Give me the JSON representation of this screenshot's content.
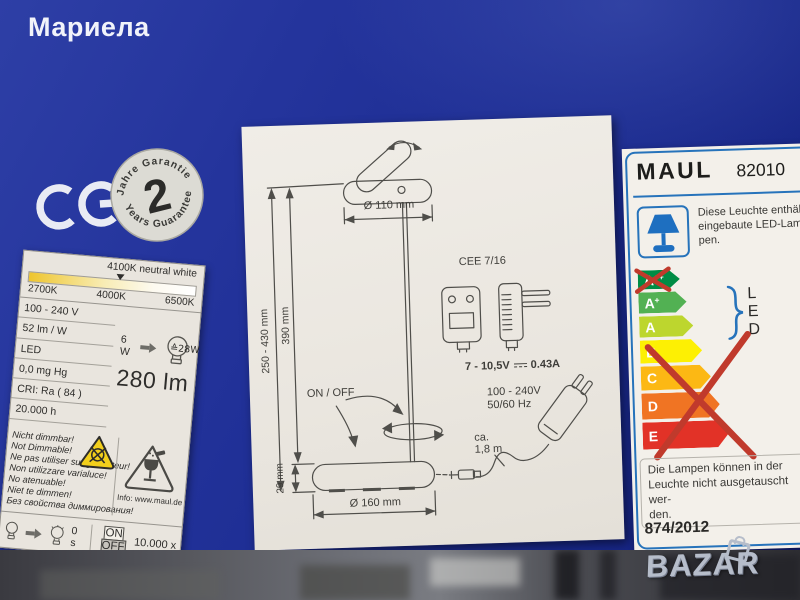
{
  "watermarks": {
    "photo_owner": "Мариела",
    "store_logo": "BAZAR"
  },
  "badges": {
    "ce_mark": "CE",
    "guarantee_top": "Jahre Garantie",
    "guarantee_number": "2",
    "guarantee_bottom": "Years Guarantee"
  },
  "spec_label": {
    "color_temp": {
      "selected": "4100K neutral white",
      "scale": [
        "2700K",
        "4000K",
        "6500K"
      ]
    },
    "rows": [
      "100 - 240 V",
      "52 lm / W",
      "LED",
      "0,0 mg  Hg",
      "CRI: Ra ( 84 )",
      "20.000 h"
    ],
    "wattage": "6 W",
    "equivalent": "≙28W",
    "luminous_flux": "280 lm",
    "warnings": [
      "Nicht dimmbar!",
      "Not Dimmable!",
      "Ne pas utiliser sur gradiateur!",
      "Non utilizzare varialuce!",
      "No atenuable!",
      "Niet te dimmen!",
      "Без свойства диммирования!"
    ],
    "info": "Info: www.maul.de",
    "switch": {
      "delay": "0 s",
      "on": "ON",
      "off": "OFF",
      "cycles": "10.000 x"
    }
  },
  "diagram": {
    "head_diameter": "Ø 110 mm",
    "height_range": "250 - 430 mm",
    "height_fixed": "390 mm",
    "base_height": "29 mm",
    "base_diameter": "Ø 160 mm",
    "switch_label": "ON / OFF",
    "plug_type": "CEE 7/16",
    "output_voltage": "7 - 10,5V",
    "output_current": "0.43A",
    "input_voltage": "100 - 240V",
    "input_frequency": "50/60 Hz",
    "cable_approx": "ca.",
    "cable_length": "1,8 m"
  },
  "energy_label": {
    "brand": "MAUL",
    "model": "82010",
    "led_note_lines": [
      "Diese Leuchte enthält",
      "eingebaute LED-Lam-",
      "pen."
    ],
    "classes": [
      {
        "letter": "A",
        "sup": "++",
        "color": "#008c45",
        "crossed": true
      },
      {
        "letter": "A",
        "sup": "+",
        "color": "#52b153",
        "crossed": false
      },
      {
        "letter": "A",
        "sup": "",
        "color": "#bdd62e",
        "crossed": false
      },
      {
        "letter": "B",
        "sup": "",
        "color": "#fdf003",
        "crossed": true
      },
      {
        "letter": "C",
        "sup": "",
        "color": "#fcb814",
        "crossed": true
      },
      {
        "letter": "D",
        "sup": "",
        "color": "#f07423",
        "crossed": true
      },
      {
        "letter": "E",
        "sup": "",
        "color": "#e23227",
        "crossed": true
      }
    ],
    "led_marker": [
      "L",
      "E",
      "D"
    ],
    "replace_note_lines": [
      "Die Lampen können in der",
      "Leuchte nicht ausgetauscht wer-",
      "den."
    ],
    "regulation": "874/2012"
  },
  "colors": {
    "box_blue": "#1d2d93",
    "energy_border_blue": "#2673bb",
    "cross_red": "#c03a2c",
    "warning_yellow": "#f2cf1c"
  }
}
